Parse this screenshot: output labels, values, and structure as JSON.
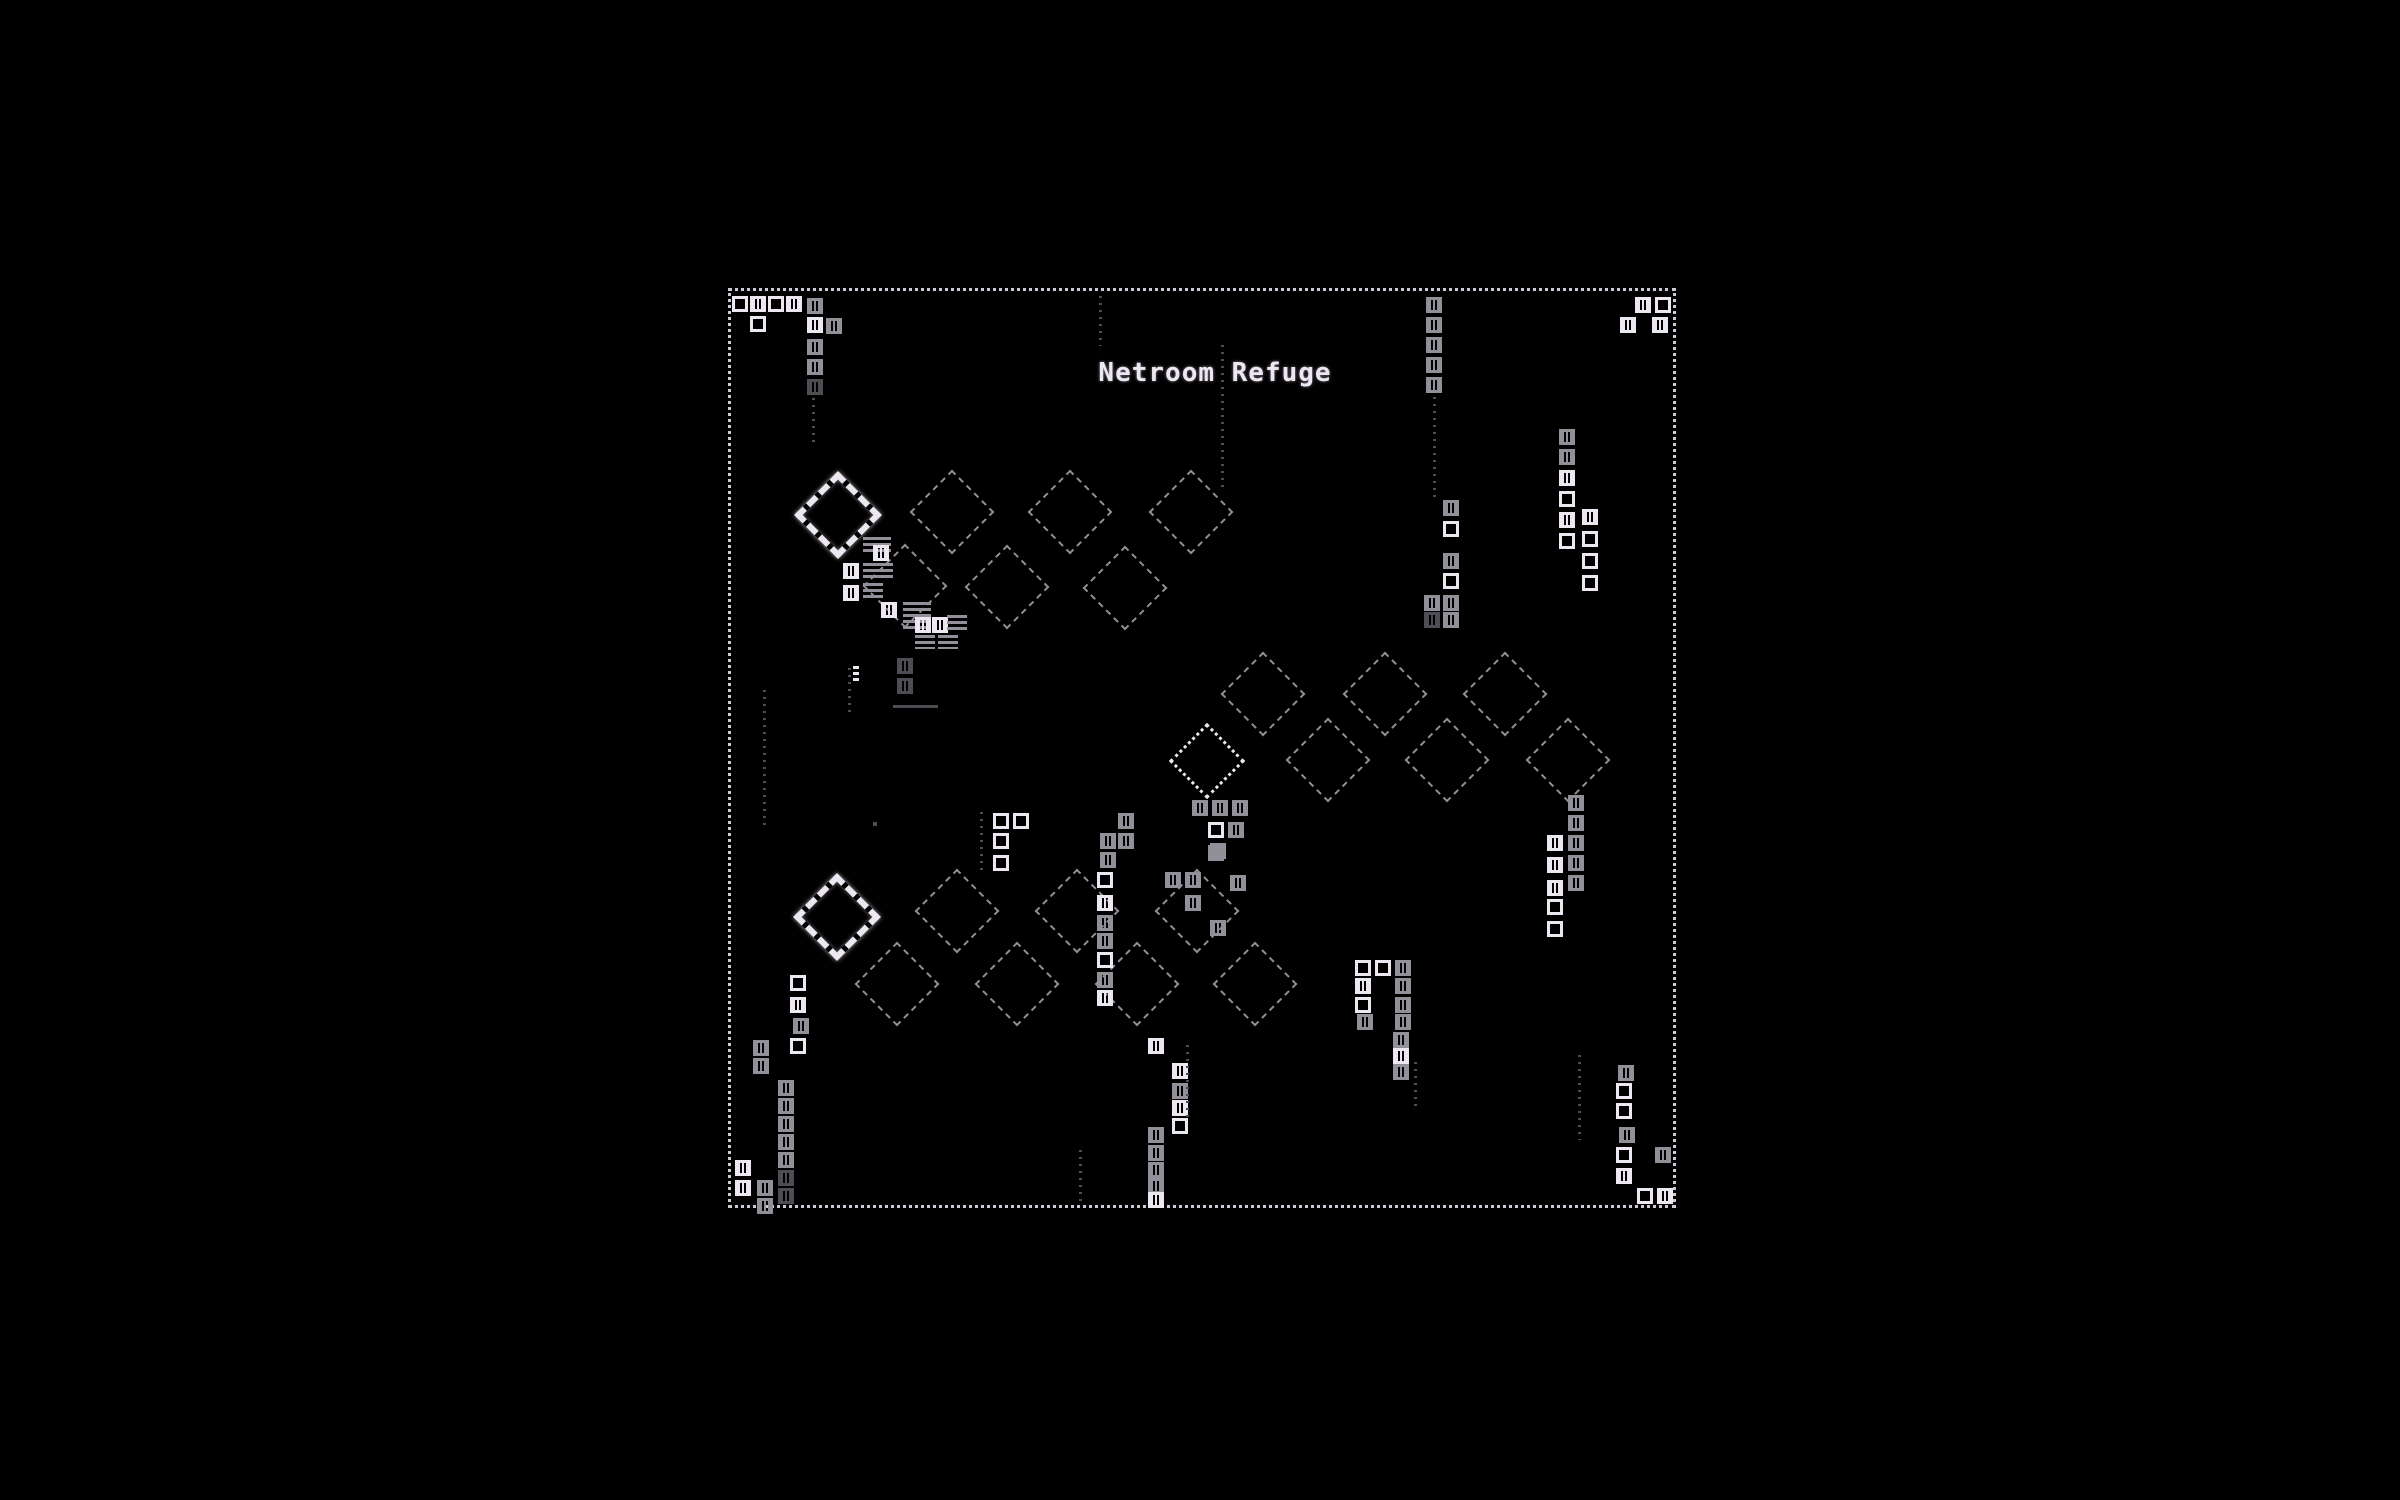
{
  "title": "Netroom Refuge",
  "colors": {
    "background": "#000000",
    "bright": "#ece7f0",
    "dim": "#938f99",
    "faint": "#4f4d53",
    "border": "#cfc9d6"
  },
  "frame": {
    "x": 728,
    "y": 288,
    "w": 948,
    "h": 920
  },
  "title_pos": {
    "x": 1215,
    "y": 358
  },
  "sprites": [
    [
      "bd",
      838,
      515,
      "b"
    ],
    [
      "bd",
      837,
      917,
      "b"
    ],
    [
      "bdd",
      1207,
      761,
      "b"
    ],
    [
      "d",
      952,
      512,
      "m"
    ],
    [
      "d",
      1070,
      512,
      "m"
    ],
    [
      "d",
      1191,
      512,
      "m"
    ],
    [
      "d",
      905,
      586,
      "m"
    ],
    [
      "d",
      1007,
      587,
      "m"
    ],
    [
      "d",
      1125,
      588,
      "m"
    ],
    [
      "d",
      1263,
      694,
      "m"
    ],
    [
      "d",
      1385,
      694,
      "m"
    ],
    [
      "d",
      1505,
      694,
      "m"
    ],
    [
      "d",
      1328,
      760,
      "m"
    ],
    [
      "d",
      1447,
      760,
      "m"
    ],
    [
      "d",
      1568,
      760,
      "m"
    ],
    [
      "d",
      957,
      911,
      "m"
    ],
    [
      "d",
      1077,
      911,
      "m"
    ],
    [
      "d",
      1197,
      911,
      "m"
    ],
    [
      "d",
      897,
      984,
      "m"
    ],
    [
      "d",
      1017,
      984,
      "m"
    ],
    [
      "d",
      1137,
      984,
      "m"
    ],
    [
      "d",
      1255,
      984,
      "m"
    ],
    [
      "o",
      732,
      296,
      "b"
    ],
    [
      "h",
      750,
      296,
      "b"
    ],
    [
      "o",
      768,
      296,
      "b"
    ],
    [
      "h",
      786,
      296,
      "b"
    ],
    [
      "o",
      750,
      316,
      "b"
    ],
    [
      "h",
      807,
      298,
      "m"
    ],
    [
      "h",
      807,
      317,
      "b"
    ],
    [
      "h",
      826,
      318,
      "m"
    ],
    [
      "h",
      807,
      339,
      "m"
    ],
    [
      "h",
      807,
      359,
      "m"
    ],
    [
      "h",
      807,
      379,
      "f"
    ],
    [
      "v",
      812,
      398,
      "f",
      45
    ],
    [
      "v",
      1099,
      296,
      "f",
      50
    ],
    [
      "v",
      1221,
      345,
      "f",
      145
    ],
    [
      "h",
      1426,
      297,
      "m"
    ],
    [
      "h",
      1426,
      317,
      "m"
    ],
    [
      "h",
      1426,
      337,
      "m"
    ],
    [
      "h",
      1426,
      357,
      "m"
    ],
    [
      "h",
      1426,
      377,
      "m"
    ],
    [
      "v",
      1433,
      397,
      "f",
      100
    ],
    [
      "h",
      1443,
      500,
      "m"
    ],
    [
      "o",
      1443,
      521,
      "b"
    ],
    [
      "h",
      1443,
      553,
      "m"
    ],
    [
      "o",
      1443,
      573,
      "b"
    ],
    [
      "h",
      1424,
      595,
      "m"
    ],
    [
      "h",
      1443,
      595,
      "m"
    ],
    [
      "h",
      1424,
      612,
      "f"
    ],
    [
      "h",
      1443,
      612,
      "m"
    ],
    [
      "h",
      1635,
      297,
      "b"
    ],
    [
      "o",
      1655,
      297,
      "b"
    ],
    [
      "h",
      1620,
      317,
      "b"
    ],
    [
      "h",
      1652,
      317,
      "b"
    ],
    [
      "h",
      1559,
      429,
      "m"
    ],
    [
      "h",
      1559,
      449,
      "m"
    ],
    [
      "h",
      1559,
      470,
      "b"
    ],
    [
      "o",
      1559,
      491,
      "b"
    ],
    [
      "h",
      1559,
      512,
      "b"
    ],
    [
      "o",
      1559,
      533,
      "b"
    ],
    [
      "h",
      1582,
      509,
      "b"
    ],
    [
      "o",
      1582,
      531,
      "b"
    ],
    [
      "o",
      1582,
      553,
      "b"
    ],
    [
      "o",
      1582,
      575,
      "b"
    ],
    [
      "dr",
      863,
      537,
      "m",
      28,
      16
    ],
    [
      "h",
      873,
      545,
      "b"
    ],
    [
      "h",
      843,
      563,
      "b"
    ],
    [
      "dr",
      863,
      563,
      "m",
      30,
      16
    ],
    [
      "h",
      843,
      585,
      "b"
    ],
    [
      "dr",
      863,
      583,
      "m",
      20,
      16
    ],
    [
      "h",
      881,
      602,
      "b"
    ],
    [
      "dr",
      903,
      602,
      "m",
      28,
      30
    ],
    [
      "h",
      915,
      617,
      "b"
    ],
    [
      "h",
      932,
      617,
      "b"
    ],
    [
      "dr",
      947,
      615,
      "m",
      20,
      18
    ],
    [
      "dr",
      915,
      635,
      "m",
      20,
      14
    ],
    [
      "dr",
      938,
      635,
      "m",
      20,
      14
    ],
    [
      "dr",
      853,
      666,
      "b",
      6,
      16
    ],
    [
      "v",
      848,
      668,
      "f",
      45
    ],
    [
      "h",
      897,
      658,
      "f"
    ],
    [
      "h",
      897,
      678,
      "f"
    ],
    [
      "dr",
      893,
      705,
      "f",
      45,
      6
    ],
    [
      "v",
      763,
      690,
      "f",
      135
    ],
    [
      "dot",
      873,
      822,
      "f"
    ],
    [
      "h",
      1192,
      800,
      "m"
    ],
    [
      "h",
      1212,
      800,
      "m"
    ],
    [
      "h",
      1232,
      800,
      "m"
    ],
    [
      "o",
      1208,
      822,
      "b"
    ],
    [
      "h",
      1228,
      822,
      "m"
    ],
    [
      "h",
      1208,
      845,
      "m"
    ],
    [
      "h",
      1568,
      795,
      "m"
    ],
    [
      "h",
      1568,
      815,
      "m"
    ],
    [
      "h",
      1568,
      835,
      "m"
    ],
    [
      "h",
      1568,
      855,
      "m"
    ],
    [
      "h",
      1568,
      875,
      "m"
    ],
    [
      "h",
      1547,
      835,
      "b"
    ],
    [
      "h",
      1547,
      857,
      "b"
    ],
    [
      "h",
      1547,
      880,
      "b"
    ],
    [
      "o",
      1547,
      899,
      "b"
    ],
    [
      "o",
      1547,
      921,
      "b"
    ],
    [
      "v",
      1578,
      1055,
      "f",
      85
    ],
    [
      "o",
      1355,
      960,
      "b"
    ],
    [
      "o",
      1375,
      960,
      "b"
    ],
    [
      "h",
      1395,
      960,
      "m"
    ],
    [
      "h",
      1355,
      978,
      "b"
    ],
    [
      "h",
      1395,
      978,
      "m"
    ],
    [
      "o",
      1355,
      997,
      "b"
    ],
    [
      "h",
      1395,
      997,
      "m"
    ],
    [
      "h",
      1357,
      1014,
      "m"
    ],
    [
      "h",
      1395,
      1014,
      "m"
    ],
    [
      "h",
      1393,
      1032,
      "m"
    ],
    [
      "h",
      1393,
      1048,
      "b"
    ],
    [
      "h",
      1393,
      1064,
      "m"
    ],
    [
      "v",
      1414,
      1062,
      "f",
      45
    ],
    [
      "o",
      993,
      813,
      "b"
    ],
    [
      "o",
      1013,
      813,
      "b"
    ],
    [
      "o",
      993,
      833,
      "b"
    ],
    [
      "o",
      993,
      855,
      "b"
    ],
    [
      "v",
      980,
      812,
      "f",
      60
    ],
    [
      "h",
      1118,
      813,
      "m"
    ],
    [
      "h",
      1100,
      833,
      "m"
    ],
    [
      "h",
      1118,
      833,
      "m"
    ],
    [
      "h",
      1100,
      852,
      "m"
    ],
    [
      "o",
      1097,
      872,
      "b"
    ],
    [
      "h",
      1097,
      895,
      "b"
    ],
    [
      "h",
      1097,
      915,
      "m"
    ],
    [
      "h",
      1097,
      933,
      "m"
    ],
    [
      "o",
      1097,
      952,
      "b"
    ],
    [
      "h",
      1097,
      972,
      "m"
    ],
    [
      "h",
      1097,
      990,
      "b"
    ],
    [
      "h",
      1210,
      843,
      "m"
    ],
    [
      "h",
      1165,
      872,
      "m"
    ],
    [
      "h",
      1185,
      872,
      "m"
    ],
    [
      "h",
      1230,
      875,
      "m"
    ],
    [
      "h",
      1185,
      895,
      "m"
    ],
    [
      "h",
      1210,
      920,
      "m"
    ],
    [
      "o",
      790,
      975,
      "b"
    ],
    [
      "h",
      790,
      997,
      "b"
    ],
    [
      "h",
      793,
      1018,
      "m"
    ],
    [
      "o",
      790,
      1038,
      "b"
    ],
    [
      "h",
      753,
      1040,
      "m"
    ],
    [
      "h",
      753,
      1058,
      "m"
    ],
    [
      "h",
      778,
      1080,
      "m"
    ],
    [
      "h",
      778,
      1098,
      "m"
    ],
    [
      "h",
      778,
      1116,
      "m"
    ],
    [
      "h",
      778,
      1134,
      "m"
    ],
    [
      "h",
      778,
      1152,
      "m"
    ],
    [
      "h",
      778,
      1170,
      "f"
    ],
    [
      "h",
      778,
      1188,
      "f"
    ],
    [
      "h",
      735,
      1160,
      "b"
    ],
    [
      "h",
      735,
      1180,
      "b"
    ],
    [
      "h",
      757,
      1180,
      "m"
    ],
    [
      "h",
      757,
      1198,
      "m"
    ],
    [
      "h",
      1148,
      1038,
      "b"
    ],
    [
      "h",
      1172,
      1063,
      "b"
    ],
    [
      "h",
      1172,
      1083,
      "m"
    ],
    [
      "h",
      1172,
      1100,
      "b"
    ],
    [
      "o",
      1172,
      1118,
      "b"
    ],
    [
      "h",
      1148,
      1127,
      "m"
    ],
    [
      "h",
      1148,
      1145,
      "m"
    ],
    [
      "h",
      1148,
      1162,
      "m"
    ],
    [
      "h",
      1148,
      1178,
      "m"
    ],
    [
      "h",
      1148,
      1192,
      "b"
    ],
    [
      "v",
      1186,
      1045,
      "f",
      75
    ],
    [
      "v",
      1079,
      1150,
      "f",
      55
    ],
    [
      "h",
      1618,
      1065,
      "m"
    ],
    [
      "o",
      1616,
      1083,
      "b"
    ],
    [
      "o",
      1616,
      1103,
      "b"
    ],
    [
      "h",
      1619,
      1127,
      "m"
    ],
    [
      "o",
      1616,
      1147,
      "b"
    ],
    [
      "h",
      1616,
      1168,
      "b"
    ],
    [
      "h",
      1655,
      1147,
      "m"
    ],
    [
      "o",
      1637,
      1188,
      "b"
    ],
    [
      "h",
      1657,
      1188,
      "b"
    ]
  ]
}
